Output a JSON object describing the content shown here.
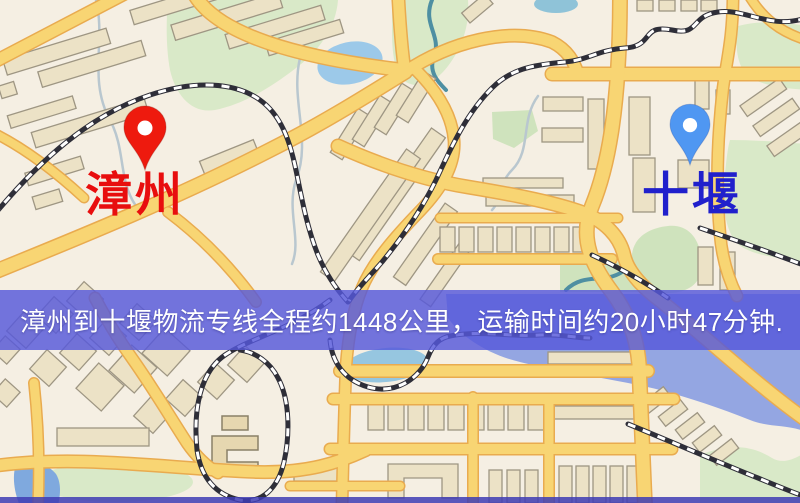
{
  "banner": {
    "text": "漳州到十堰物流专线全程约1448公里，运输时间约20小时47分钟.",
    "background_color": "#5658da",
    "text_color": "#ffffff"
  },
  "route": {
    "origin": "漳州",
    "destination": "十堰",
    "distance": "约1448公里",
    "duration": "约20小时47分钟"
  },
  "markers": [
    {
      "city": "漳州",
      "pin_color": "#ee1a0e",
      "label_color": "#e80e0e",
      "side": "left"
    },
    {
      "city": "十堰",
      "pin_color": "#4f97f2",
      "label_color": "#2020cc",
      "side": "right"
    }
  ],
  "map_colors": {
    "background": "#f5efe3",
    "road_fill": "#f8d573",
    "road_casing": "#e9ab4f",
    "building": "#ece2c6",
    "park": "#d9e9c8",
    "pond": "#9cc9e9",
    "lagoon": "#94a6e2",
    "railway": "#2e2e38"
  }
}
